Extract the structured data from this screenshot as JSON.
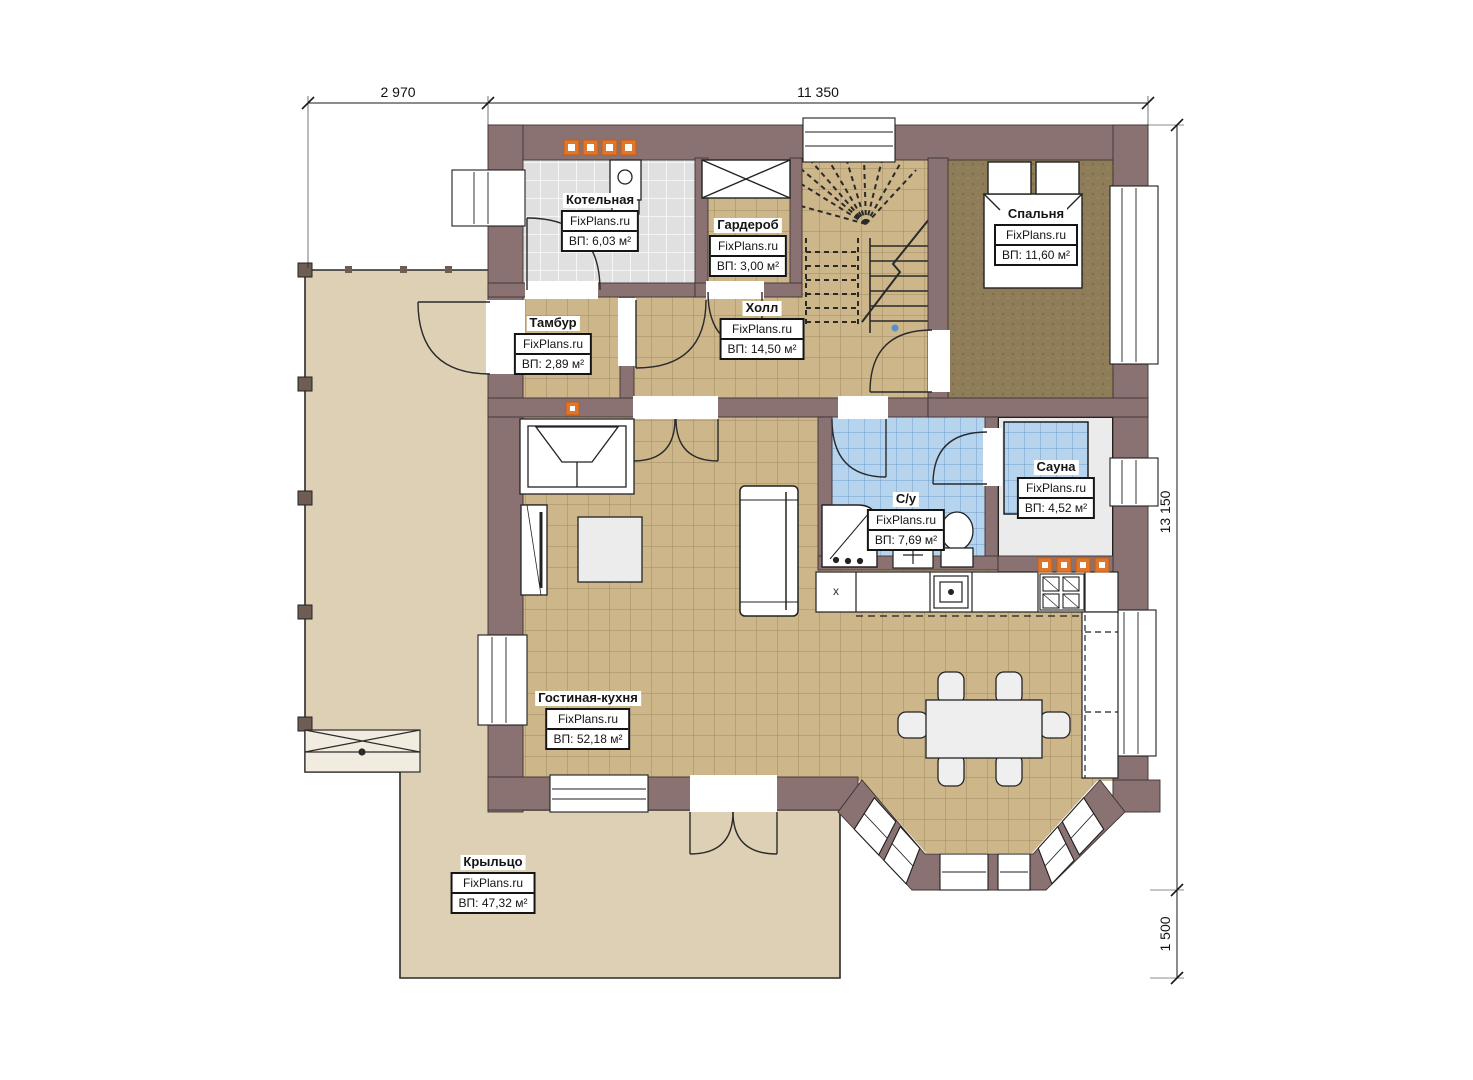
{
  "brand": "FixPlans.ru",
  "rooms": [
    {
      "name": "Котельная",
      "area": "ВП: 6,03 м²"
    },
    {
      "name": "Гардероб",
      "area": "ВП: 3,00 м²"
    },
    {
      "name": "Спальня",
      "area": "ВП: 11,60 м²"
    },
    {
      "name": "Тамбур",
      "area": "ВП: 2,89 м²"
    },
    {
      "name": "Холл",
      "area": "ВП: 14,50 м²"
    },
    {
      "name": "С/у",
      "area": "ВП: 7,69 м²"
    },
    {
      "name": "Сауна",
      "area": "ВП: 4,52 м²"
    },
    {
      "name": "Гостиная-кухня",
      "area": "ВП: 52,18 м²"
    },
    {
      "name": "Крыльцо",
      "area": "ВП: 47,32 м²"
    }
  ],
  "dimensions": {
    "top_left": "2 970",
    "top_right": "11 350",
    "right_height": "13 150",
    "right_lower": "1 500"
  },
  "kitchen": {
    "cabinet_mark": "x"
  },
  "colors": {
    "wall": "#8a7272",
    "floor_tile": "#ccb68a",
    "bedroom_floor": "#8f7c58",
    "wet_tile": "#b7d4ef",
    "boiler_tile": "#e0e0e0",
    "porch": "#ddd0b5",
    "radiator": "#e0762b",
    "bench": "#ebebeb"
  }
}
